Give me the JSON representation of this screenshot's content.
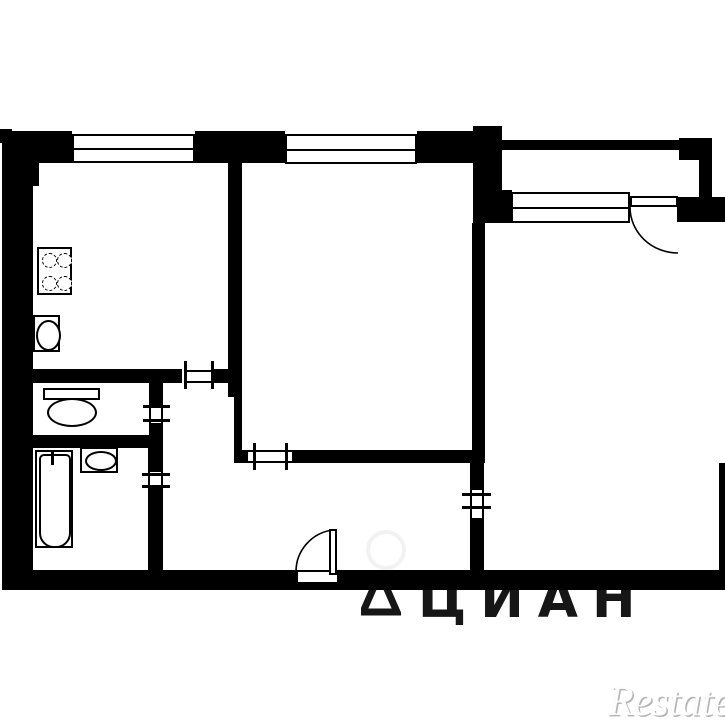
{
  "plan": {
    "background_color": "#ffffff",
    "wall_color": "#000000",
    "icons": {
      "stove": "stove-icon: 2x2 dashed burner circles in rectangle",
      "kitchen_sink": "sink-icon: oval basin in rectangle",
      "toilet": "toilet-icon: tank rectangle with oval bowl",
      "bathtub": "bathtub-icon: rounded inner rim with tap mark",
      "washbasin": "washbasin-icon: oval basin in rectangle",
      "window": "window-icon: double-line glazing band in wall opening",
      "door_opening": "door-opening-icon: thin opening with perpendicular tick marks",
      "swing_door": "swing-door-icon: door leaf with quarter-circle swing arc"
    }
  },
  "watermarks": {
    "center_logo_text": "ЦИАН",
    "center_logo_color": "#161616",
    "corner_text": "Restate",
    "corner_color": "#c8c8c8"
  }
}
